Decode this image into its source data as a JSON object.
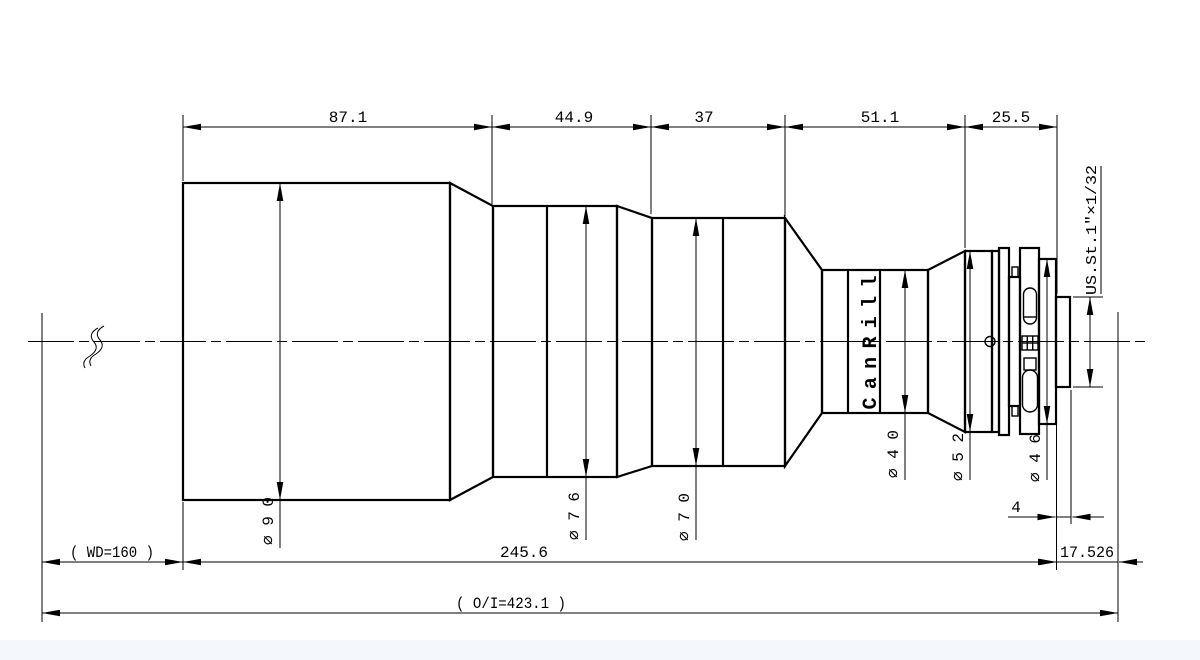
{
  "colors": {
    "line": "#000000",
    "background": "#ffffff",
    "bottom_strip": "#f4f8fc"
  },
  "drawing": {
    "brand": "CanRill",
    "thread_spec": "US.St.1″×1/32",
    "top_dimensions": [
      "87.1",
      "44.9",
      "37",
      "51.1",
      "25.5"
    ],
    "diameter_labels": [
      "⌀90",
      "⌀76",
      "⌀70",
      "⌀40",
      "⌀52",
      "⌀46"
    ],
    "thread_length": "4",
    "working_distance": "( WD=160 )",
    "body_length": "245.6",
    "flange_distance": "17.526",
    "overall_distance": "( O/I=423.1 )"
  }
}
